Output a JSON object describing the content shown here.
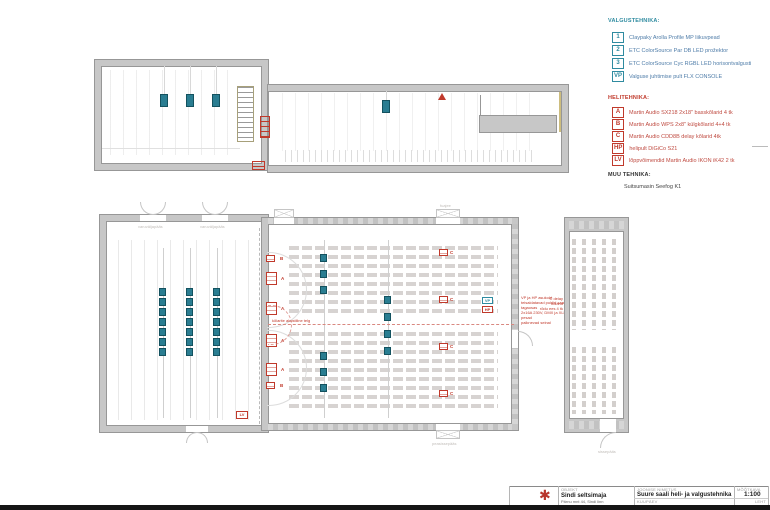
{
  "legend": {
    "lighting": {
      "title": "VALGUSTEHNIKA:",
      "items": [
        {
          "key": "1",
          "label": "Claypaky Arolla Profile MP liikuvpead"
        },
        {
          "key": "2",
          "label": "ETC ColorSource Par DB LED prožektor"
        },
        {
          "key": "3",
          "label": "ETC ColorSource Cyc RGBL LED horisontvalgusti"
        },
        {
          "key": "VP",
          "label": "Valguse juhtimise pult FLX CONSOLE"
        }
      ]
    },
    "audio": {
      "title": "HELITEHNIKA:",
      "items": [
        {
          "key": "A",
          "label": "Martin Audio SX218 2x18\" basskõlarid 4 tk"
        },
        {
          "key": "B",
          "label": "Martin Audio WPS 2x8\" külgkõlarid 4+4 tk"
        },
        {
          "key": "C",
          "label": "Martin Audio CDD8B delay kõlarid 4tk"
        },
        {
          "key": "HP",
          "label": "helipult DiGiCo S21"
        },
        {
          "key": "LV",
          "label": "lõppvõimendid Martin Audio IKON iK42 2 tk"
        }
      ]
    },
    "other": {
      "title": "MUU TEHNIKA:",
      "items": [
        {
          "label": "Suitsumasin Seefog K1"
        }
      ]
    }
  },
  "title_block": {
    "object_label": "OBJEKT",
    "object_name": "Sindi seltsimaja",
    "object_address": "Pärnu mnt 44, Sindi linn",
    "drawing_label": "JOONISE NIMETUS",
    "drawing_name": "Suure saali heli- ja valgustehnika",
    "scale_label": "MÕÕTKAVA",
    "scale_value": "1:100",
    "date_label": "KUUPÄEV",
    "sheet_label": "LEHT"
  },
  "labels": {
    "stage_exit_left": "varuväljapääs",
    "stage_exit_right": "varuväljapääs",
    "hall_top_door": "fuajee",
    "hall_entrance": "peasissepääs",
    "balcony_entrance": "sissepääs"
  },
  "notes": {
    "axis_note": "kõlarite akustiline telg",
    "wall_note_lines": [
      "VP ja HP asukoht",
      "teisaldatavad puldid saali tagaosas",
      "2x16A 230V, DMX ja XLR pesad",
      "paiknevad seinal"
    ],
    "balcony_note_lines": [
      "C delay kõlarid",
      "rõdu ees 4 tk"
    ]
  },
  "symbols": {
    "proscenium_speakers": [
      "B",
      "A",
      "A",
      "A",
      "A",
      "B"
    ],
    "delay_speakers": [
      "C",
      "C",
      "C",
      "C"
    ],
    "consoles": [
      "VP",
      "HP"
    ],
    "lv": "LV"
  },
  "counts": {
    "stage_batten_fixtures": 7,
    "hall_front_upper": 3,
    "hall_front_lower": 3,
    "hall_mid": 4
  }
}
